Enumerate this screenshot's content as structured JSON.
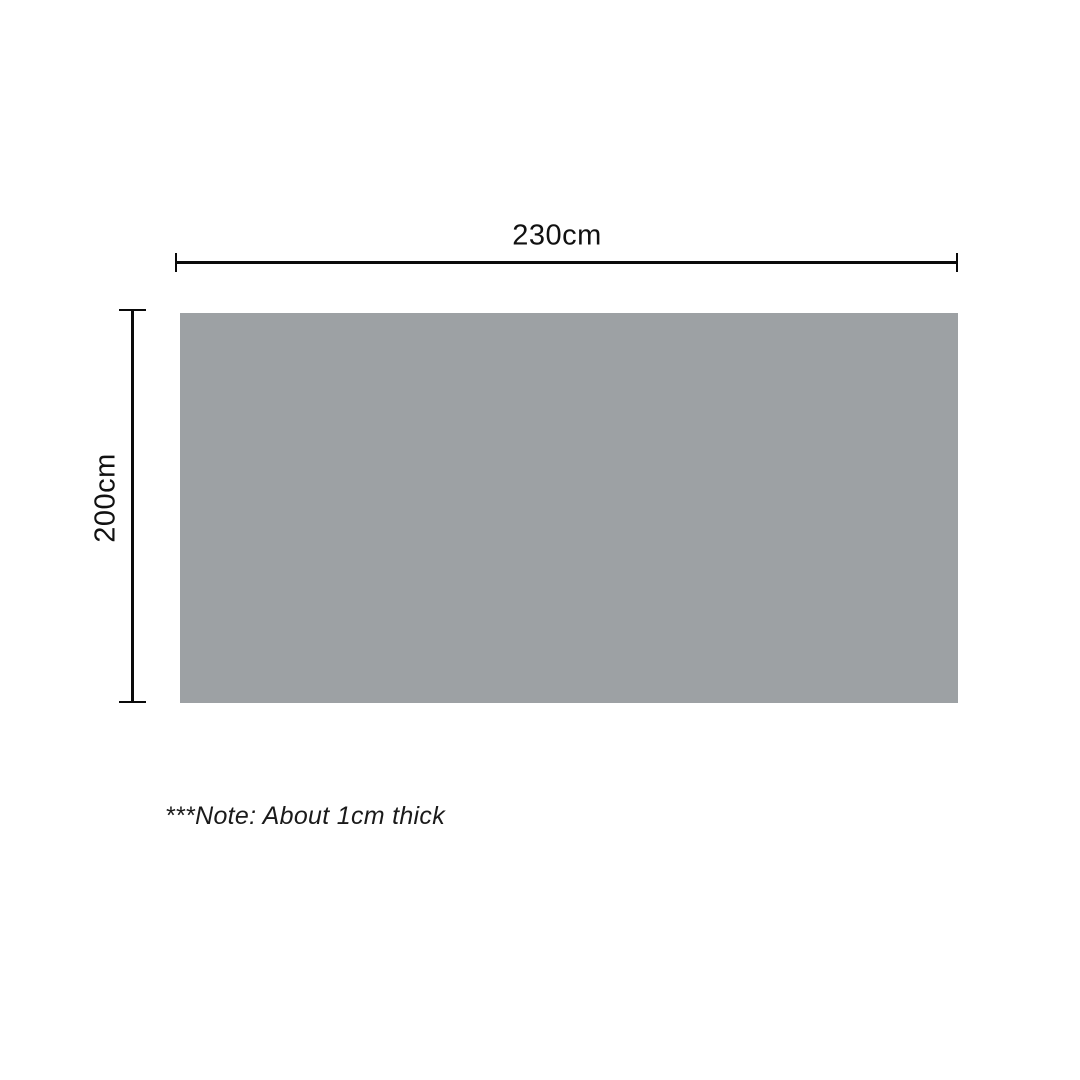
{
  "diagram": {
    "title": "product-dimension-diagram",
    "panel": {
      "fill_color": "#9da1a4",
      "width_label": "230cm",
      "height_label": "200cm"
    },
    "note_text": "***Note: About 1cm thick",
    "line_color": "#0a0a0a",
    "background_color": "#ffffff"
  }
}
